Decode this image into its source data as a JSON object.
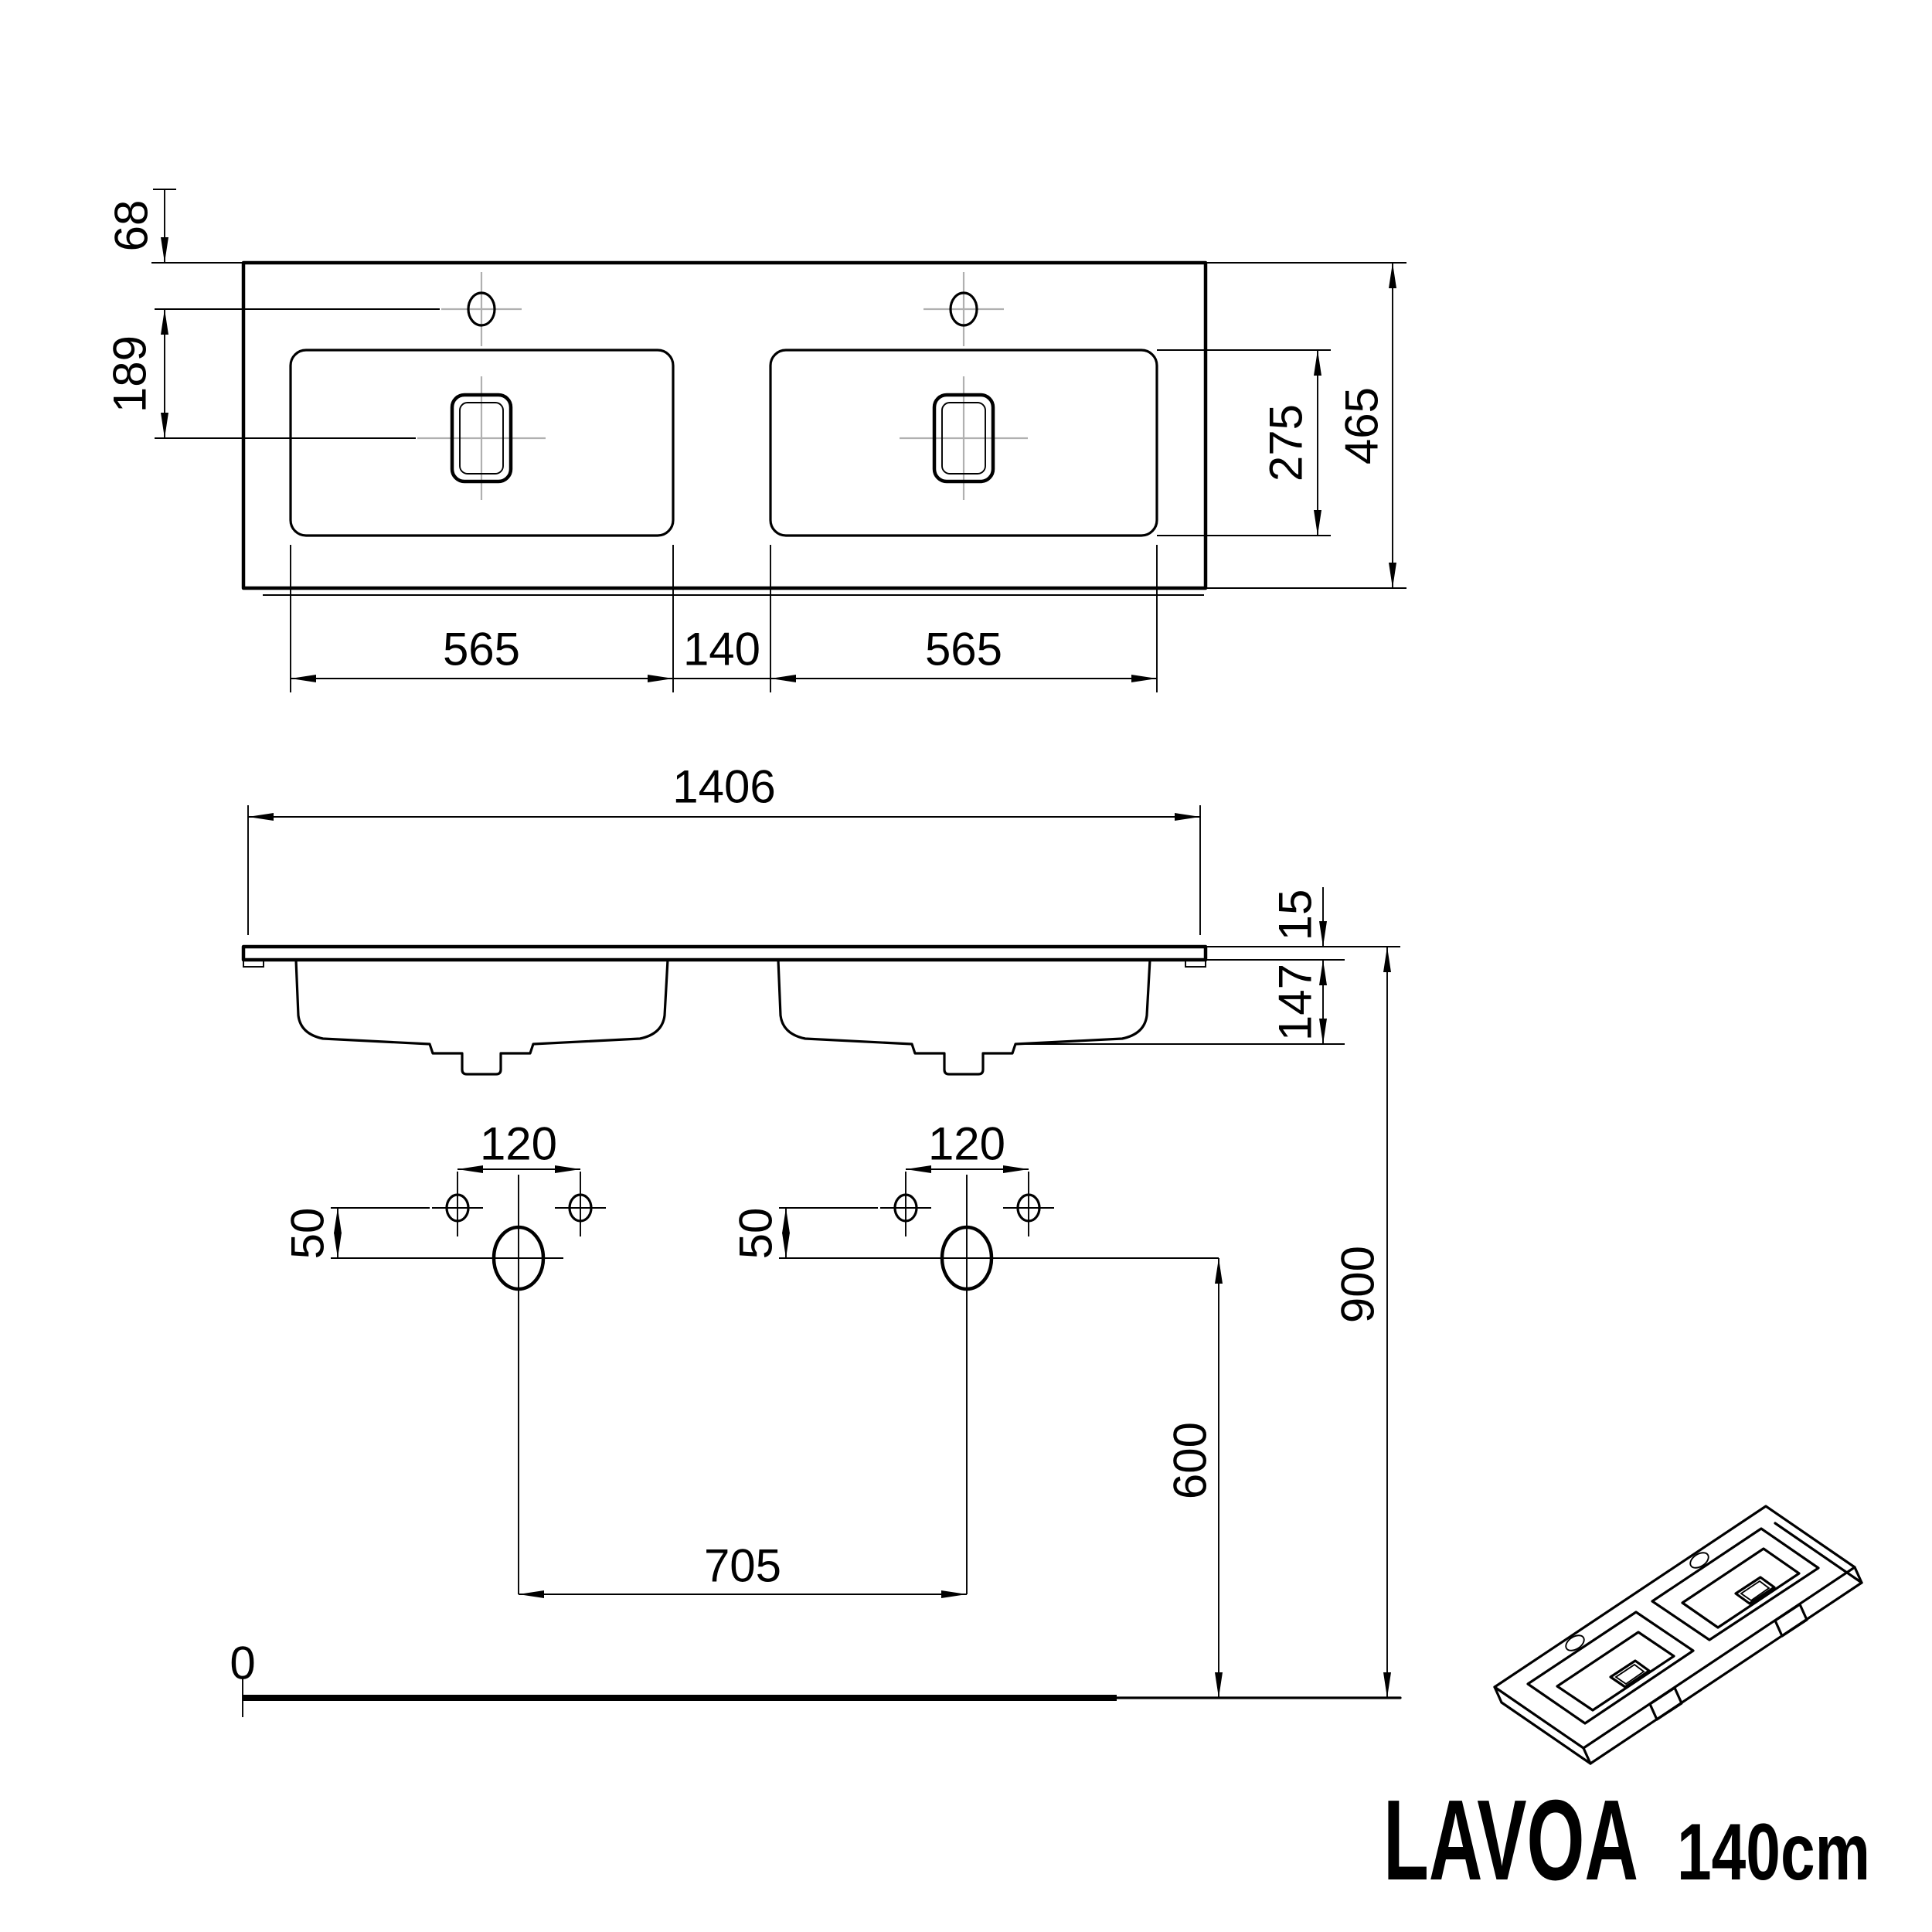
{
  "logo": {
    "name": "LAVOA",
    "size": "140cm"
  },
  "plan_view": {
    "back_to_faucet": "68",
    "faucet_to_drain": "189",
    "left_bowl_width": "565",
    "bowl_gap": "140",
    "right_bowl_width": "565",
    "bowl_front_back": "275",
    "overall_depth": "465"
  },
  "front_view": {
    "overall_width": "1406",
    "rim_thickness": "15",
    "bowl_depth": "147"
  },
  "installation_view": {
    "fixing_span_left": "120",
    "fixing_span_right": "120",
    "faucet_offset_left": "50",
    "faucet_offset_right": "50",
    "drain_span": "705",
    "drain_height": "600",
    "rim_height": "900",
    "floor_level": "0"
  }
}
